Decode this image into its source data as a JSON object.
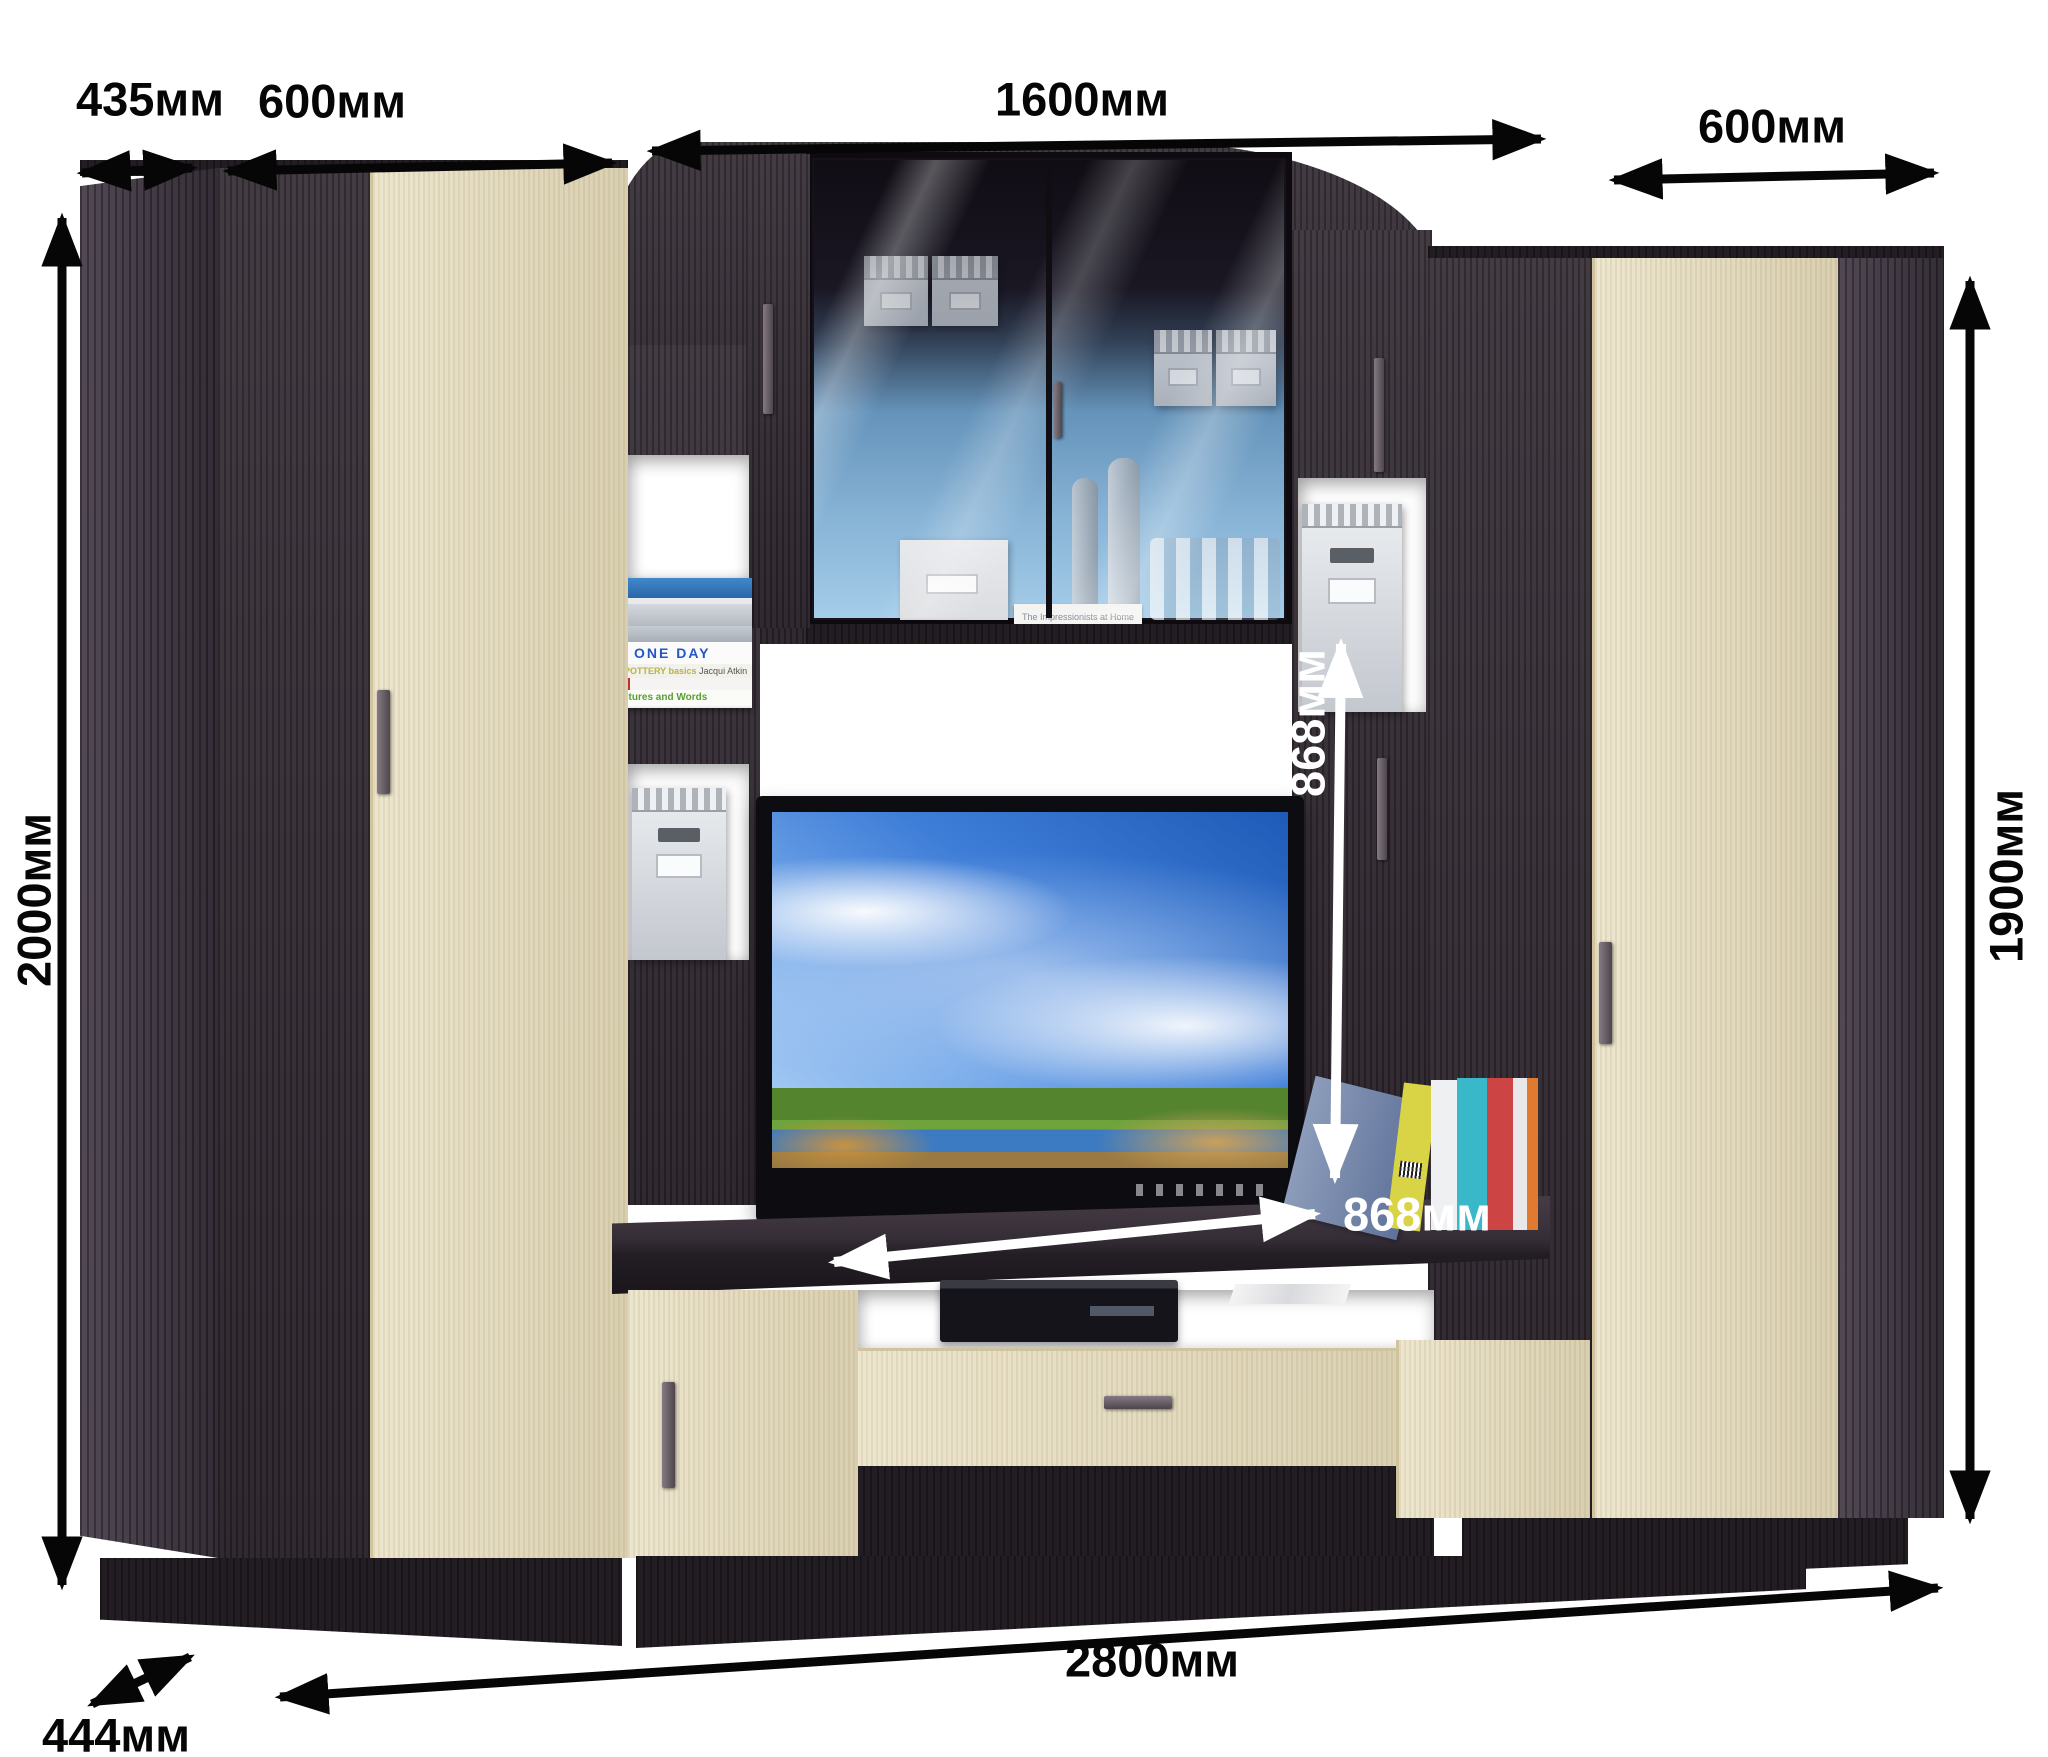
{
  "dimensions": {
    "top_depth": {
      "label": "435мм",
      "value": 435,
      "unit": "мм"
    },
    "left_section_width": {
      "label": "600мм",
      "value": 600,
      "unit": "мм"
    },
    "center_section_width": {
      "label": "1600мм",
      "value": 1600,
      "unit": "мм"
    },
    "right_section_width": {
      "label": "600мм",
      "value": 600,
      "unit": "мм"
    },
    "left_height": {
      "label": "2000мм",
      "value": 2000,
      "unit": "мм"
    },
    "right_height": {
      "label": "1900мм",
      "value": 1900,
      "unit": "мм"
    },
    "niche_height": {
      "label": "868мм",
      "value": 868,
      "unit": "мм"
    },
    "niche_width": {
      "label": "868мм",
      "value": 868,
      "unit": "мм"
    },
    "total_width": {
      "label": "2800мм",
      "value": 2800,
      "unit": "мм"
    },
    "base_depth": {
      "label": "444мм",
      "value": 444,
      "unit": "мм"
    }
  },
  "books": {
    "one_day": "ONE DAY",
    "pottery": "POTTERY basics",
    "pottery_author": "Jacqui Atkin",
    "words": "ctures and Words",
    "impressionists": "The Impressionists at Home"
  },
  "colors": {
    "background": "#ffffff",
    "wenge_dark": "#332b33",
    "wenge_deep": "#221c23",
    "oak_light": "#e6dcbb",
    "annotation_black": "#060606",
    "annotation_white": "#ffffff",
    "glass_blue": "#7eb0d8",
    "tv_sky_blue": "#3f7ed8"
  }
}
